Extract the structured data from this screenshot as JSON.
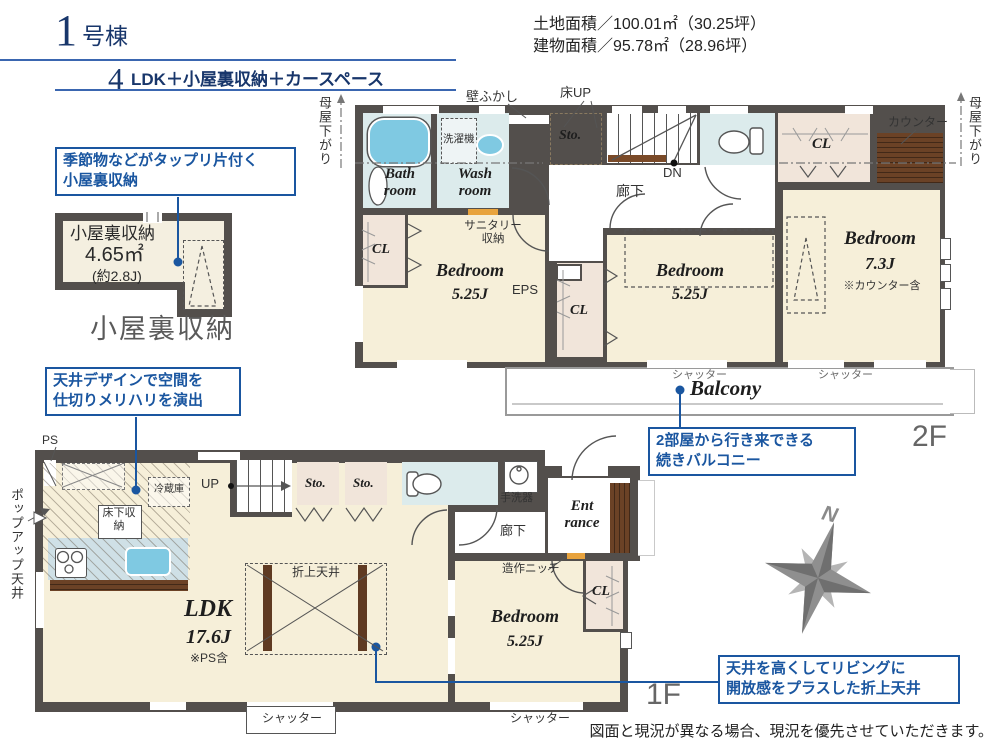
{
  "header": {
    "unit_number": "1",
    "unit_suffix": "号棟",
    "layout_prefix": "4",
    "layout_text": "LDK＋小屋裏収納＋カースペース",
    "land_area": "土地面積／100.01㎡（30.25坪）",
    "building_area": "建物面積／95.78㎡（28.96坪）"
  },
  "callouts": {
    "attic": "季節物などがタップリ片付く\n小屋裏収納",
    "ceiling_design": "天井デザインで空間を\n仕切りメリハリを演出",
    "balcony": "2部屋から行き来できる\n続きバルコニー",
    "folded_ceiling": "天井を高くしてリビングに\n開放感をプラスした折上天井"
  },
  "attic": {
    "name": "小屋裏収納",
    "area_sqm": "4.65㎡",
    "area_jo": "(約2.8J)",
    "caption": "小屋裏収納"
  },
  "floor2": {
    "label": "2F",
    "bath": "Bath\nroom",
    "wash": "Wash\nroom",
    "washer": "洗濯機",
    "wall_fukashi": "壁ふかし",
    "floor_up": "床UP",
    "storage": "Sto.",
    "dn": "DN",
    "hallway": "廊下",
    "sanitary": "サニタリー\n収納",
    "eps": "EPS",
    "cl": "CL",
    "counter": "カウンター",
    "bedroom": "Bedroom",
    "bedroom_size_a": "5.25J",
    "bedroom_size_b": "5.25J",
    "bedroom_size_c": "7.3J",
    "bedroom_note_c": "※カウンター含",
    "moya_sagari": "母屋下がり",
    "shutter": "シャッター",
    "balcony": "Balcony"
  },
  "floor1": {
    "label": "1F",
    "ps": "PS",
    "popup_ceiling": "ポップアップ天井",
    "fridge": "冷蔵庫",
    "up": "UP",
    "underfloor_storage": "床下収納",
    "storage": "Sto.",
    "hand_basin": "手洗器",
    "hallway": "廊下",
    "entrance": "Ent\nrance",
    "niche": "造作ニッチ",
    "folded_ceiling": "折上天井",
    "ldk": "LDK",
    "ldk_size": "17.6J",
    "ldk_note": "※PS含",
    "bedroom": "Bedroom",
    "bedroom_size": "5.25J",
    "cl": "CL",
    "shutter": "シャッター"
  },
  "compass": {
    "north": "N"
  },
  "footer": {
    "disclaimer": "図面と現況が異なる場合、現況を優先させていただきます。"
  },
  "colors": {
    "accent_blue": "#1a56a0",
    "title_navy": "#18366b",
    "wall": "#534f4c",
    "floor_cream": "#f6efd9",
    "floor_wet": "#dcebec",
    "floor_closet": "#f1e5da",
    "fixture_blue": "#7fc9e2",
    "wood_brown": "#6b4226"
  }
}
